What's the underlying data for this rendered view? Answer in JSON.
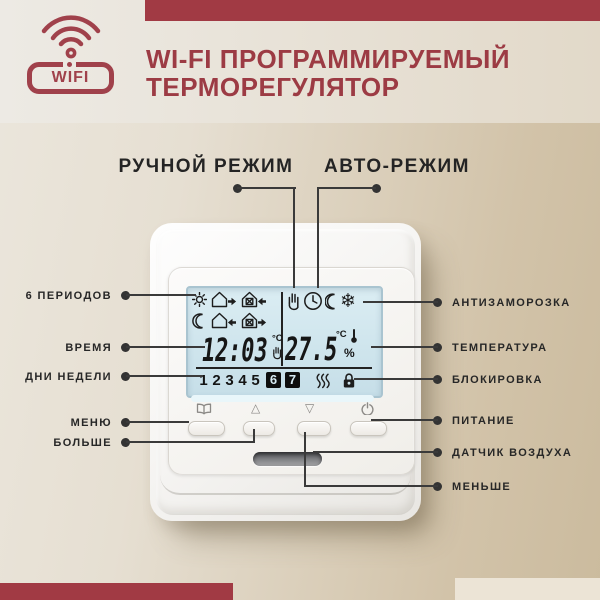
{
  "colors": {
    "accent_red": "#A13A44",
    "title_red": "#9C3B44",
    "label_dark": "#272727",
    "lcd_blue": "#CFE5ED",
    "bg_left": "#E6DFD2",
    "bg_right": "#CBBB9E"
  },
  "header": {
    "wifi_badge": "WIFI",
    "title_line1": "WI-FI ПРОГРАММИРУЕМЫЙ",
    "title_line2": "ТЕРМОРЕГУЛЯТОР"
  },
  "top_callouts": {
    "manual": "РУЧНОЙ РЕЖИМ",
    "auto": "АВТО-РЕЖИМ"
  },
  "left_callouts": [
    {
      "label": "6 ПЕРИОДОВ"
    },
    {
      "label": "ВРЕМЯ"
    },
    {
      "label": "ДНИ НЕДЕЛИ"
    },
    {
      "label": "МЕНЮ"
    },
    {
      "label": "БОЛЬШЕ"
    }
  ],
  "right_callouts": [
    {
      "label": "АНТИЗАМОРОЗКА"
    },
    {
      "label": "ТЕМПЕРАТУРА"
    },
    {
      "label": "БЛОКИРОВКА"
    },
    {
      "label": "ПИТАНИЕ"
    },
    {
      "label": "ДАТЧИК ВОЗДУХА"
    },
    {
      "label": "МЕНЬШЕ"
    }
  ],
  "device": {
    "lcd": {
      "time": "12:03",
      "time_unit": "°C",
      "temperature": "27.5",
      "temp_unit": "°C",
      "humidity_unit": "%",
      "days": [
        "1",
        "2",
        "3",
        "4",
        "5",
        "6",
        "7"
      ],
      "active_days": "6,7",
      "icons": [
        "sun",
        "house-exit-arrow",
        "house-service-enter-arrow",
        "moon",
        "house-enter-arrow",
        "house-service-exit-arrow",
        "hand-manual",
        "clock",
        "moon-night",
        "snowflake",
        "heating-waves",
        "lock"
      ]
    },
    "buttons": [
      {
        "icon": "menu-book"
      },
      {
        "icon": "arrow-up"
      },
      {
        "icon": "arrow-down"
      },
      {
        "icon": "power"
      }
    ]
  }
}
